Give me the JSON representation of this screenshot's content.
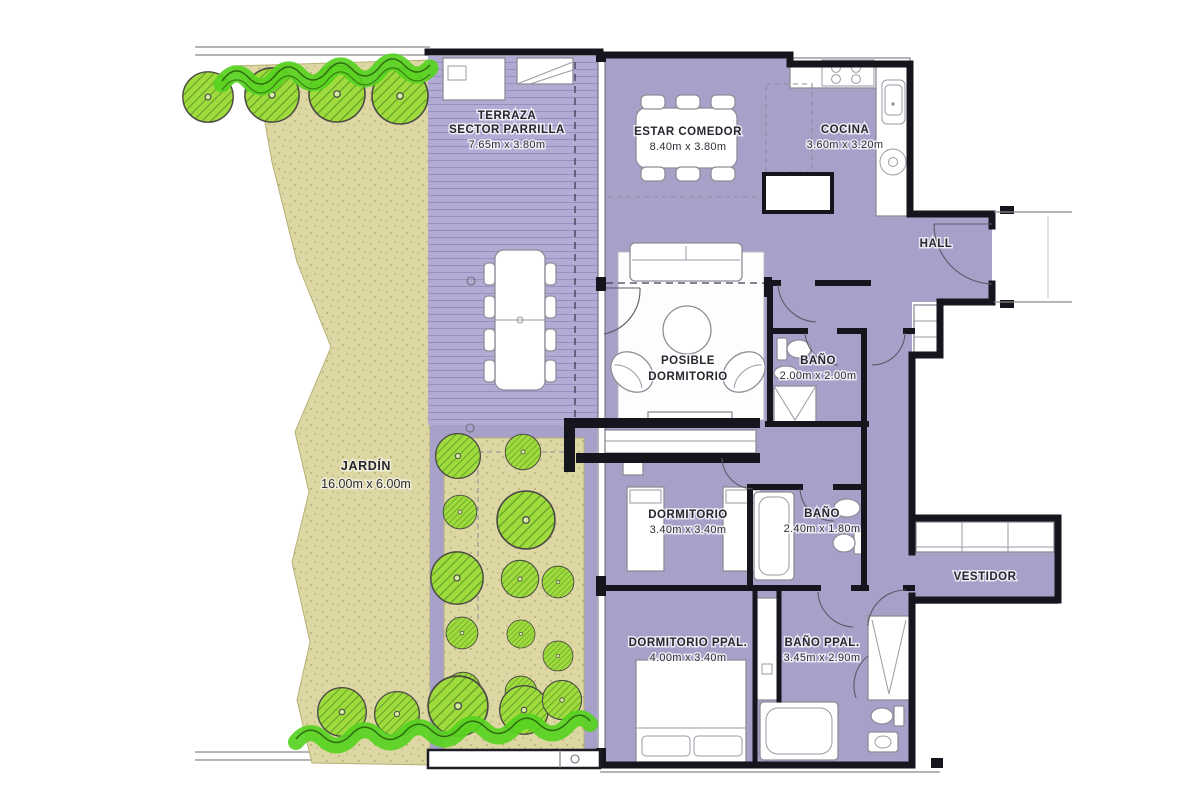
{
  "floorplan": {
    "rooms": {
      "terraza": {
        "line1": "TERRAZA",
        "line2": "SECTOR PARRILLA",
        "dims": "7.65m x 3.80m"
      },
      "estar_comedor": {
        "name": "ESTAR COMEDOR",
        "dims": "8.40m x 3.80m"
      },
      "cocina": {
        "name": "COCINA",
        "dims": "3.60m x 3.20m"
      },
      "hall": {
        "name": "HALL"
      },
      "posible_dormitorio": {
        "line1": "POSIBLE",
        "line2": "DORMITORIO"
      },
      "bano_hall": {
        "name": "BAÑO",
        "dims": "2.00m x 2.00m"
      },
      "jardin": {
        "name": "JARDÍN",
        "dims": "16.00m x 6.00m"
      },
      "dormitorio": {
        "name": "DORMITORIO",
        "dims": "3.40m x 3.40m"
      },
      "bano_dormitorio": {
        "name": "BAÑO",
        "dims": "2.40m x 1.80m"
      },
      "vestidor": {
        "name": "VESTIDOR"
      },
      "dormitorio_ppal": {
        "name": "DORMITORIO PPAL.",
        "dims": "4.00m x 3.40m"
      },
      "bano_ppal": {
        "name": "BAÑO PPAL.",
        "dims": "3.45m x 2.90m"
      }
    },
    "colors": {
      "floor": "#a7a0c9",
      "terrace": "#b2abd3",
      "terrace_stripe": "#978fc0",
      "garden": "#ddd7a4",
      "garden_speckle": "#b2ab70",
      "tree_fill": "#a0db3e",
      "tree_hatch": "#5fa124",
      "hedge": "#57d31f",
      "wall": "#15151d",
      "furniture": "#ffffff",
      "label": "#26262f"
    }
  }
}
